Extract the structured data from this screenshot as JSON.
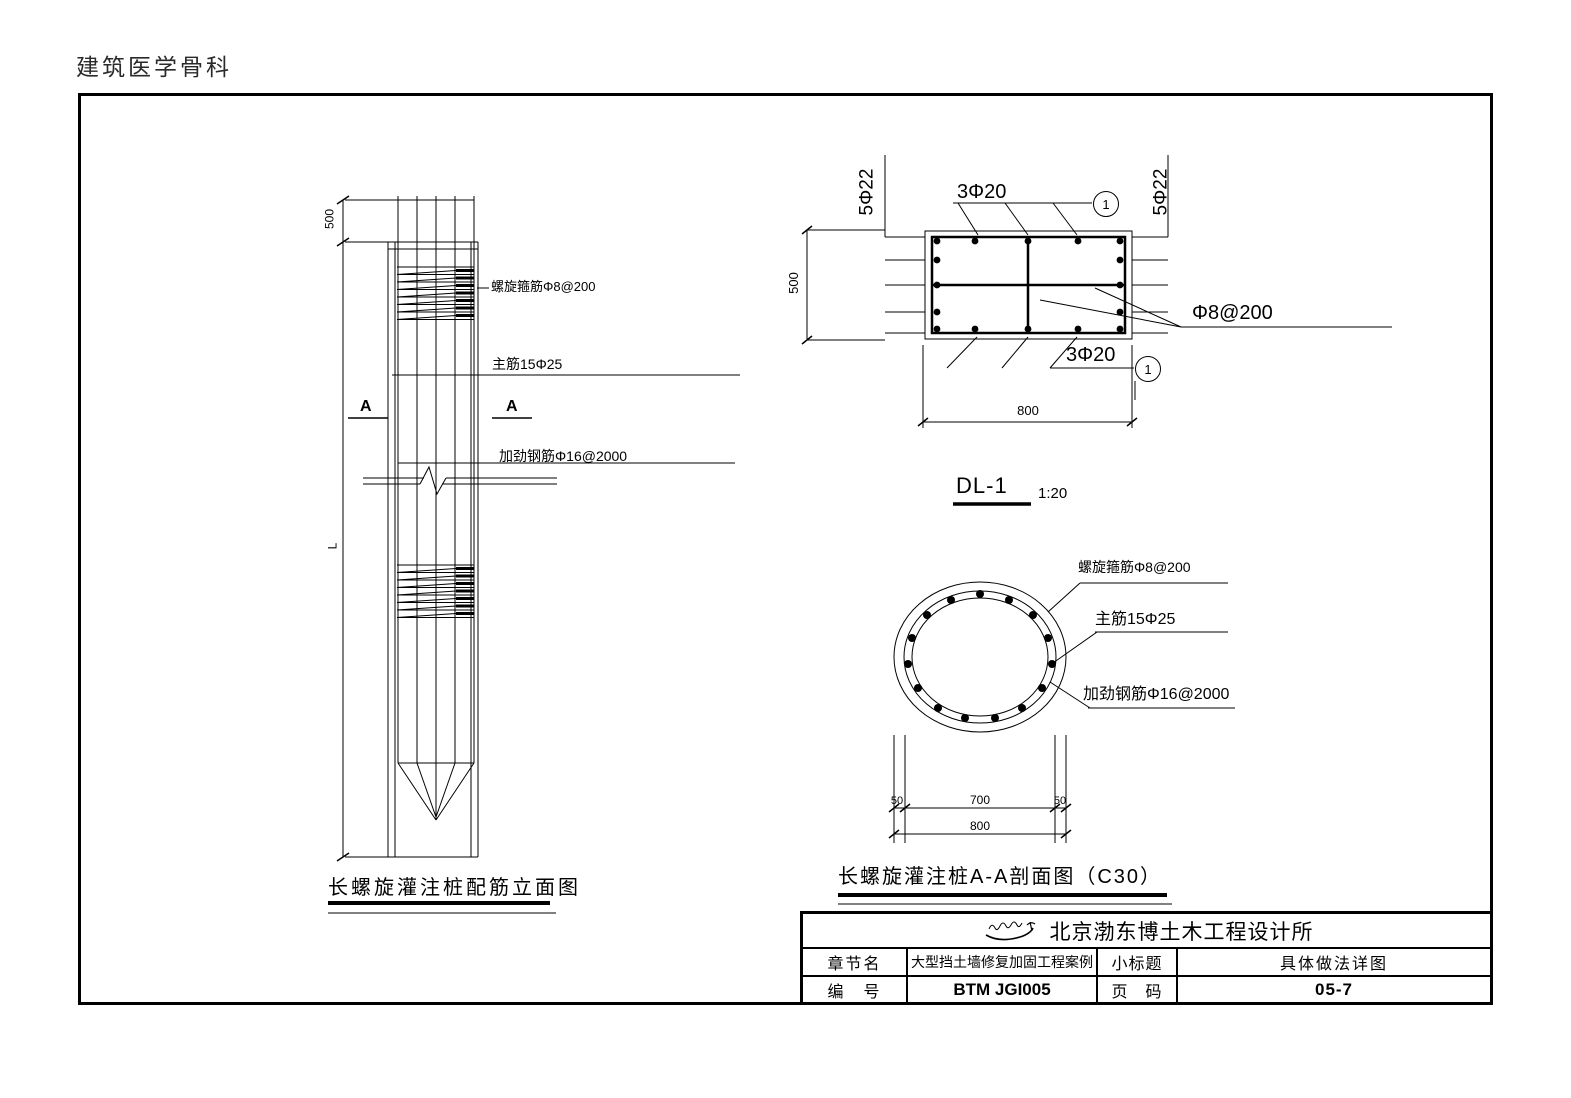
{
  "page": {
    "header": "建筑医学骨科"
  },
  "elevation": {
    "title": "长螺旋灌注桩配筋立面图",
    "section_marker": "A",
    "ann_spiral": "螺旋箍筋Φ8@200",
    "ann_main": "主筋15Φ25",
    "ann_stiffener": "加劲钢筋Φ16@2000",
    "dim_top": "500",
    "dim_length": "L"
  },
  "dl1": {
    "label": "DL-1",
    "scale": "1:20",
    "side_bars": "5Φ22",
    "top_bars": "3Φ20",
    "bottom_bars": "3Φ20",
    "stirrup": "Φ8@200",
    "dim_height": "500",
    "dim_width": "800",
    "callout": "1"
  },
  "section_aa": {
    "title": "长螺旋灌注桩A-A剖面图（C30）",
    "ann_spiral": "螺旋箍筋Φ8@200",
    "ann_main": "主筋15Φ25",
    "ann_stiffener": "加劲钢筋Φ16@2000",
    "dim_cover_left": "50",
    "dim_core": "700",
    "dim_cover_right": "50",
    "dim_total": "800"
  },
  "title_block": {
    "company": "北京渤东博土木工程设计所",
    "chapter_label": "章节名",
    "chapter_value": "大型挡土墙修复加固工程案例",
    "subtitle_label": "小标题",
    "subtitle_value": "具体做法详图",
    "number_label": "编　号",
    "number_value": "BTM JGI005",
    "page_label": "页　码",
    "page_value": "05-7"
  }
}
